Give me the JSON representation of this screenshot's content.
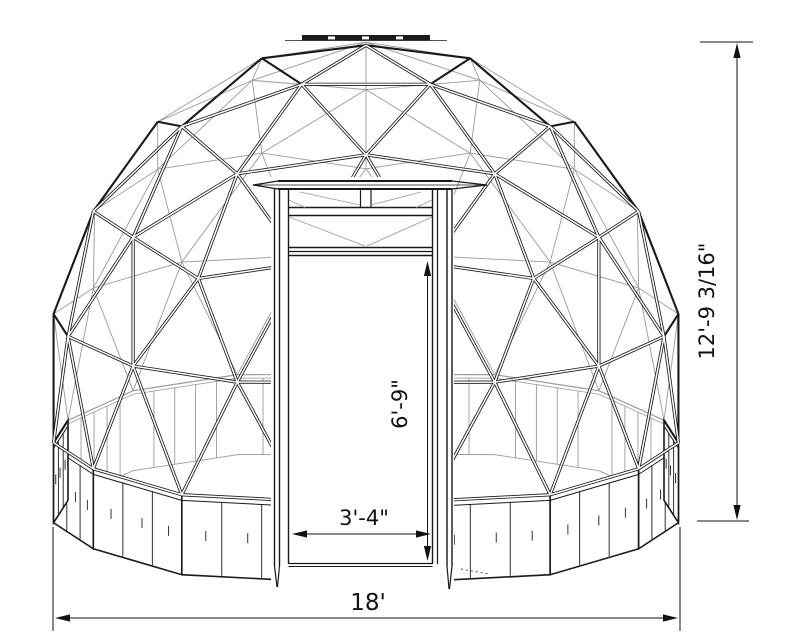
{
  "diagram": {
    "type": "geodesic-dome-greenhouse-front-elevation",
    "dimensions": {
      "overall_height": "12'-9 3/16\"",
      "overall_width": "18'",
      "door_height": "6'-9\"",
      "door_width": "3'-4\""
    },
    "colors": {
      "line": "#1a1a1a",
      "hidden_line": "#9a9a9a",
      "background": "#ffffff"
    }
  }
}
